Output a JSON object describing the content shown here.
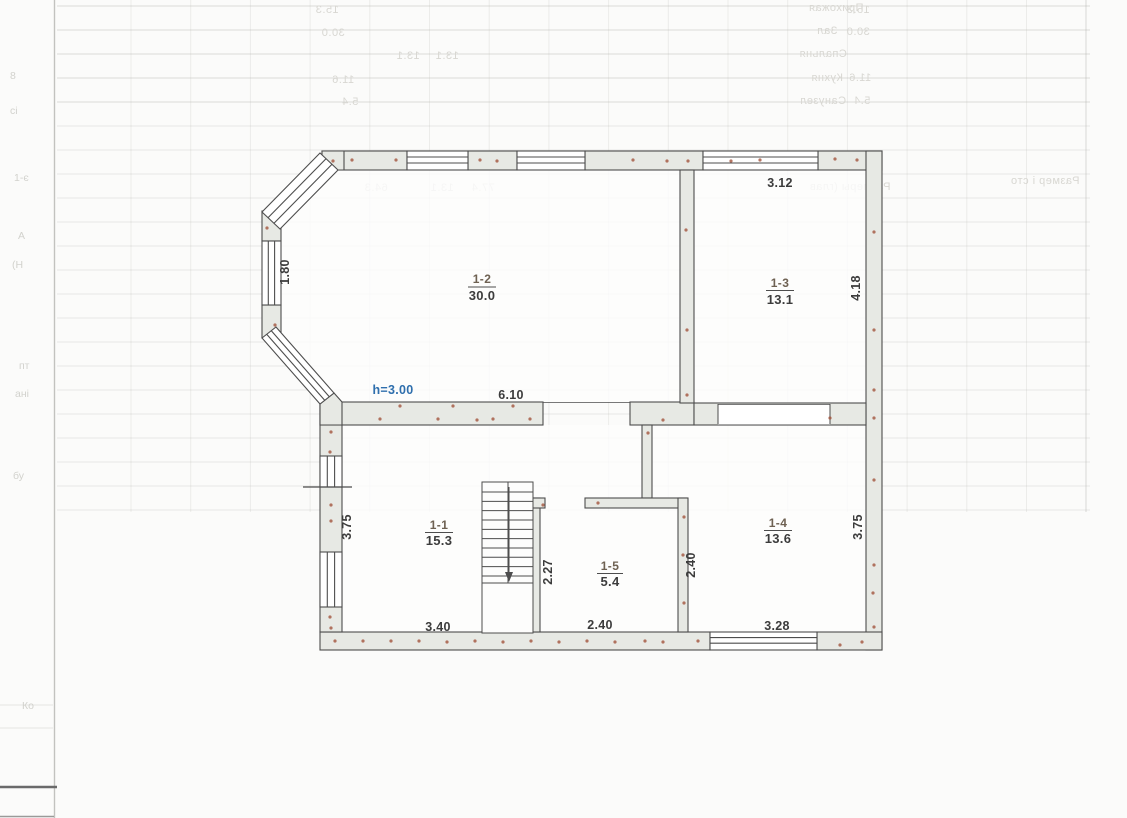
{
  "page": {
    "background": "#fbfbfa",
    "fold_line_color": "#c2c2bf",
    "footer_bar_color": "#6a6a6a"
  },
  "floor_plan": {
    "wall_fill": "#e7e9e4",
    "wall_stroke": "#4d4d4d",
    "room_fill": "rgba(253,253,252,0.82)",
    "artifact_dot_color": "#a3543c",
    "ceiling_height_label": {
      "text": "h=3.00",
      "color": "#2f6fad"
    },
    "rooms": [
      {
        "number": "1-1",
        "area": "15.3"
      },
      {
        "number": "1-2",
        "area": "30.0"
      },
      {
        "number": "1-3",
        "area": "13.1"
      },
      {
        "number": "1-4",
        "area": "13.6"
      },
      {
        "number": "1-5",
        "area": "5.4"
      }
    ],
    "dimensions": {
      "room_1_3_width": "3.12",
      "room_1_3_height": "4.18",
      "bay_window_height": "1.80",
      "room_1_2_width": "6.10",
      "room_1_1_height": "3.75",
      "room_1_1_width": "3.40",
      "room_1_5_height": "2.27",
      "room_1_5_width": "2.40",
      "room_1_4_height_left": "2.40",
      "room_1_4_height_right": "3.75",
      "room_1_4_width": "3.28"
    },
    "artifact_dots": [
      [
        352,
        160
      ],
      [
        396,
        160
      ],
      [
        480,
        160
      ],
      [
        497,
        161
      ],
      [
        633,
        160
      ],
      [
        667,
        161
      ],
      [
        688,
        161
      ],
      [
        731,
        161
      ],
      [
        760,
        160
      ],
      [
        835,
        159
      ],
      [
        857,
        160
      ],
      [
        333,
        161
      ],
      [
        874,
        232
      ],
      [
        874,
        330
      ],
      [
        874,
        390
      ],
      [
        874,
        418
      ],
      [
        874,
        480
      ],
      [
        874,
        565
      ],
      [
        873,
        593
      ],
      [
        874,
        627
      ],
      [
        335,
        641
      ],
      [
        363,
        641
      ],
      [
        391,
        641
      ],
      [
        419,
        641
      ],
      [
        447,
        642
      ],
      [
        475,
        641
      ],
      [
        503,
        642
      ],
      [
        531,
        641
      ],
      [
        559,
        642
      ],
      [
        587,
        641
      ],
      [
        615,
        642
      ],
      [
        645,
        641
      ],
      [
        663,
        642
      ],
      [
        698,
        641
      ],
      [
        840,
        645
      ],
      [
        862,
        642
      ],
      [
        331,
        432
      ],
      [
        330,
        452
      ],
      [
        331,
        505
      ],
      [
        331,
        521
      ],
      [
        330,
        617
      ],
      [
        331,
        628
      ],
      [
        267,
        228
      ],
      [
        275,
        325
      ],
      [
        400,
        406
      ],
      [
        453,
        406
      ],
      [
        513,
        406
      ],
      [
        380,
        419
      ],
      [
        438,
        419
      ],
      [
        477,
        420
      ],
      [
        493,
        419
      ],
      [
        530,
        419
      ],
      [
        663,
        420
      ],
      [
        830,
        418
      ],
      [
        686,
        230
      ],
      [
        687,
        330
      ],
      [
        687,
        395
      ],
      [
        648,
        433
      ],
      [
        684,
        517
      ],
      [
        683,
        555
      ],
      [
        684,
        603
      ],
      [
        598,
        503
      ],
      [
        543,
        505
      ]
    ]
  },
  "bleed_through": {
    "grid_color": "180,180,176",
    "text_color": "#d8d7d2",
    "texts": [
      {
        "text": "Прихожая",
        "x": 836,
        "y": 11
      },
      {
        "text": "15.3",
        "x": 327,
        "y": 13
      },
      {
        "text": "15.3",
        "x": 858,
        "y": 13
      },
      {
        "text": "Зал",
        "x": 827,
        "y": 34
      },
      {
        "text": "30.0",
        "x": 333,
        "y": 36
      },
      {
        "text": "30.0",
        "x": 858,
        "y": 35
      },
      {
        "text": "Спальня",
        "x": 823,
        "y": 57
      },
      {
        "text": "13.1",
        "x": 408,
        "y": 59
      },
      {
        "text": "13.1",
        "x": 447,
        "y": 59
      },
      {
        "text": "Кухня",
        "x": 827,
        "y": 81
      },
      {
        "text": "11.6",
        "x": 343,
        "y": 83
      },
      {
        "text": "11.6",
        "x": 860,
        "y": 81
      },
      {
        "text": "Санузел",
        "x": 823,
        "y": 104
      },
      {
        "text": "5.4",
        "x": 350,
        "y": 105
      },
      {
        "text": "5.4",
        "x": 862,
        "y": 104
      },
      {
        "text": "64.3",
        "x": 376,
        "y": 191
      },
      {
        "text": "13.1",
        "x": 442,
        "y": 191
      },
      {
        "text": "77.4",
        "x": 483,
        "y": 191
      },
      {
        "text": "Размеры (глав",
        "x": 850,
        "y": 190
      },
      {
        "text": "Размер і сто",
        "x": 1045,
        "y": 184
      }
    ],
    "margin_marks": [
      {
        "text": "8",
        "x": 10,
        "y": 79
      },
      {
        "text": "сі",
        "x": 10,
        "y": 114
      },
      {
        "text": "1-є",
        "x": 14,
        "y": 181
      },
      {
        "text": "А",
        "x": 18,
        "y": 239
      },
      {
        "text": "(Н",
        "x": 12,
        "y": 268
      },
      {
        "text": "пт",
        "x": 19,
        "y": 369
      },
      {
        "text": "ані",
        "x": 15,
        "y": 397
      },
      {
        "text": "бу",
        "x": 13,
        "y": 479
      },
      {
        "text": "Ко",
        "x": 22,
        "y": 709
      }
    ]
  }
}
